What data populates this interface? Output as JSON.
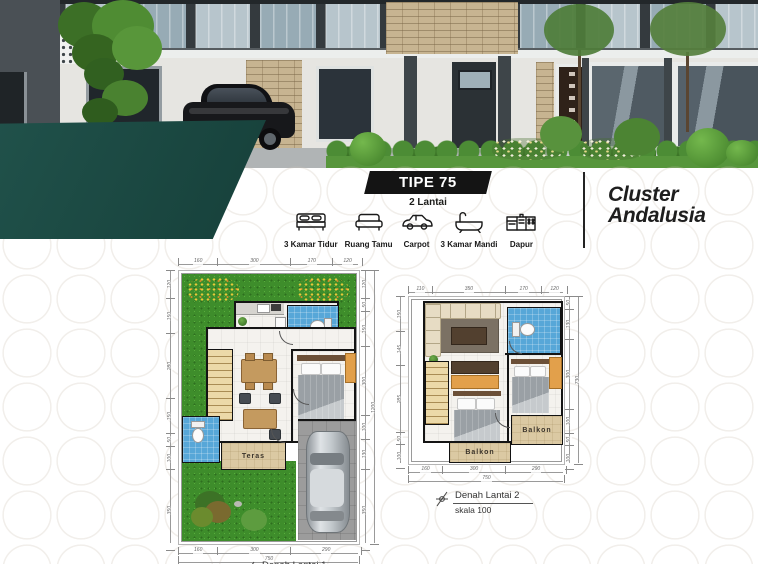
{
  "title_block": {
    "type_label": "TIPE 75",
    "floors_label": "2 Lantai",
    "features": [
      {
        "icon": "bed-icon",
        "label": "3 Kamar Tidur"
      },
      {
        "icon": "sofa-icon",
        "label": "Ruang Tamu"
      },
      {
        "icon": "car-icon",
        "label": "Carpot"
      },
      {
        "icon": "bathtub-icon",
        "label": "3 Kamar Mandi"
      },
      {
        "icon": "kitchen-icon",
        "label": "Dapur"
      }
    ],
    "cluster_line1": "Cluster",
    "cluster_line2": "Andalusia"
  },
  "floorplan1": {
    "dims_top": [
      "160",
      "300",
      "170",
      "120"
    ],
    "dims_left": [
      "120",
      "150",
      "280",
      "150",
      "50",
      "100",
      "350"
    ],
    "dims_right": [
      "120",
      "50",
      "150",
      "300",
      "100",
      "130",
      "350"
    ],
    "dims_right_total": "1200",
    "dims_bottom": [
      "160",
      "300",
      "290"
    ],
    "dims_bottom_total": "750",
    "room_labels": {
      "teras": "Teras"
    },
    "caption_title": "Denah Lantai 1"
  },
  "floorplan2": {
    "dims_top": [
      "110",
      "350",
      "170",
      "120"
    ],
    "dims_left": [
      "150",
      "145",
      "285",
      "50",
      "100"
    ],
    "dims_right": [
      "50",
      "130",
      "300",
      "100",
      "50",
      "100"
    ],
    "dims_right_total": "730",
    "dims_bottom": [
      "160",
      "300",
      "290"
    ],
    "dims_bottom_total": "750",
    "room_labels": {
      "balkon_center": "Balkon",
      "balkon_right": "Balkon"
    },
    "caption_title": "Denah Lantai 2",
    "caption_scale": "skala 100"
  },
  "colors": {
    "teal_ribbon": "#1b4a43",
    "type_banner": "#141414",
    "lawn_green": "#3e8d2b",
    "bath_blue": "#57a7d8",
    "balcony_beige": "#dbc9a3",
    "furniture_orange": "#e2a04b"
  }
}
